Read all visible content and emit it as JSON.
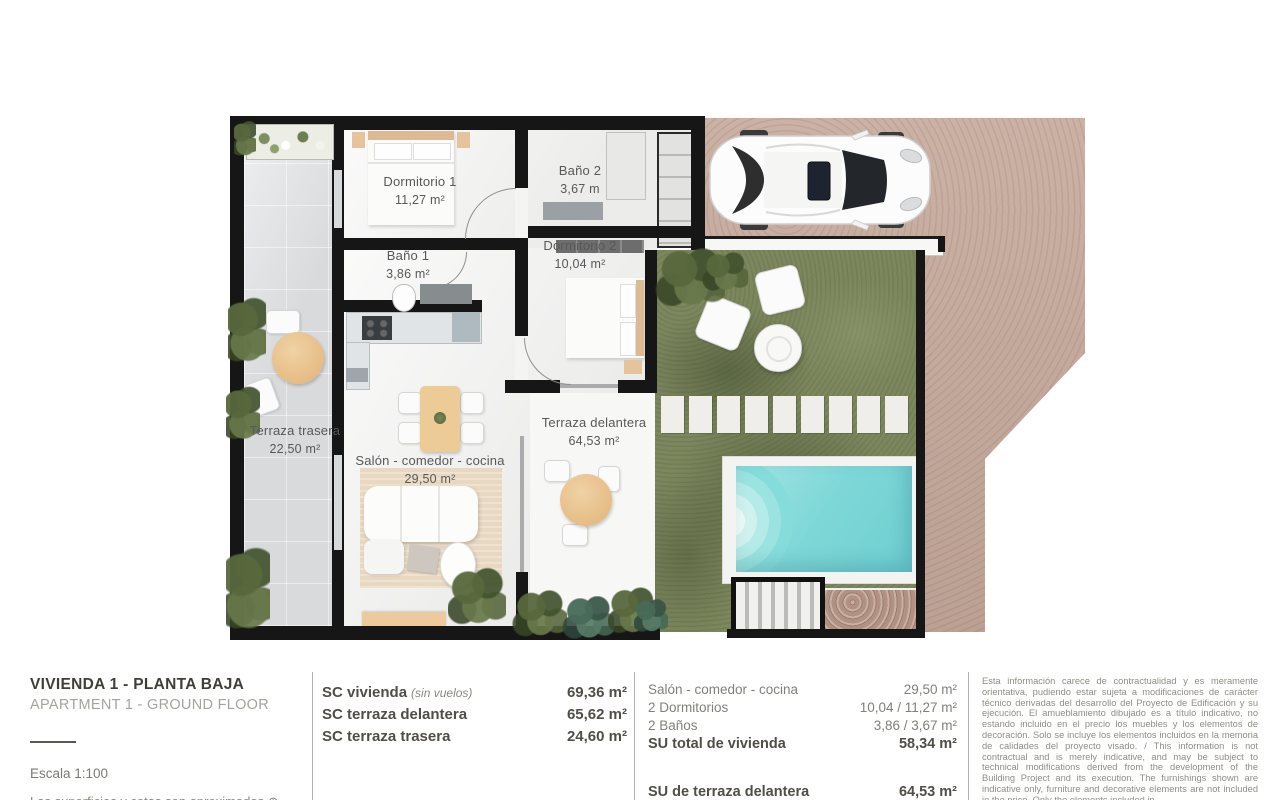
{
  "plan": {
    "rooms": {
      "dormitorio1": {
        "name": "Dormitorio 1",
        "area": "11,27 m²"
      },
      "bano2": {
        "name": "Baño 2",
        "area": "3,67 m"
      },
      "dormitorio2": {
        "name": "Dormitorio 2",
        "area": "10,04 m²"
      },
      "bano1": {
        "name": "Baño 1",
        "area": "3,86 m²"
      },
      "terraza_trasera": {
        "name": "Terraza trasera",
        "area": "22,50 m²"
      },
      "salon": {
        "name": "Salón - comedor - cocina",
        "area": "29,50 m²"
      },
      "terraza_delantera": {
        "name": "Terraza delantera",
        "area": "64,53 m²"
      }
    }
  },
  "footer": {
    "title": "VIVIENDA 1 - PLANTA BAJA",
    "subtitle": "APARTMENT 1 - GROUND FLOOR",
    "scale_label": "Escala  1:100",
    "clipped_note": "Las superficies y cotas son aproximadas ⊕",
    "sc_rows": [
      {
        "label": "SC vivienda",
        "note": "(sin vuelos)",
        "value": "69,36 m²"
      },
      {
        "label": "SC terraza delantera",
        "note": "",
        "value": "65,62 m²"
      },
      {
        "label": "SC terraza trasera",
        "note": "",
        "value": "24,60 m²"
      }
    ],
    "su_rows": [
      {
        "label": "Salón - comedor - cocina",
        "value": "29,50 m²"
      },
      {
        "label": "2 Dormitorios",
        "value": "10,04 / 11,27 m²"
      },
      {
        "label": "2 Baños",
        "value": "3,86 / 3,67 m²"
      },
      {
        "label": "SU total de vivienda",
        "value": "58,34 m²"
      },
      {
        "label": "SU de terraza delantera",
        "value": "64,53 m²"
      }
    ],
    "disclaimer": "Esta información carece de contractualidad y es meramente orientativa, pudiendo estar sujeta a modificaciones de carácter técnico derivadas del desarrollo del Proyecto de Edificación y su ejecución. El amueblamiento dibujado es a título indicativo, no estando incluido en el precio los muebles y los elementos de decoración. Solo se incluye los elementos incluidos en la memoria de calidades del proyecto visado. / This information is not contractual and is merely indicative, and may be subject to technical modifications derived from the development of the Building Project and its execution. The furnishings shown are indicative only, furniture and decorative elements are not included in the price. Only the elements included in"
  },
  "colors": {
    "wall": "#161616",
    "driveway": "#c5a99b",
    "grass": "#7c875d",
    "pool_water": "#7ed7d7",
    "terrace_tile": "#d9dadc",
    "wood_accent": "#e9c28e"
  }
}
